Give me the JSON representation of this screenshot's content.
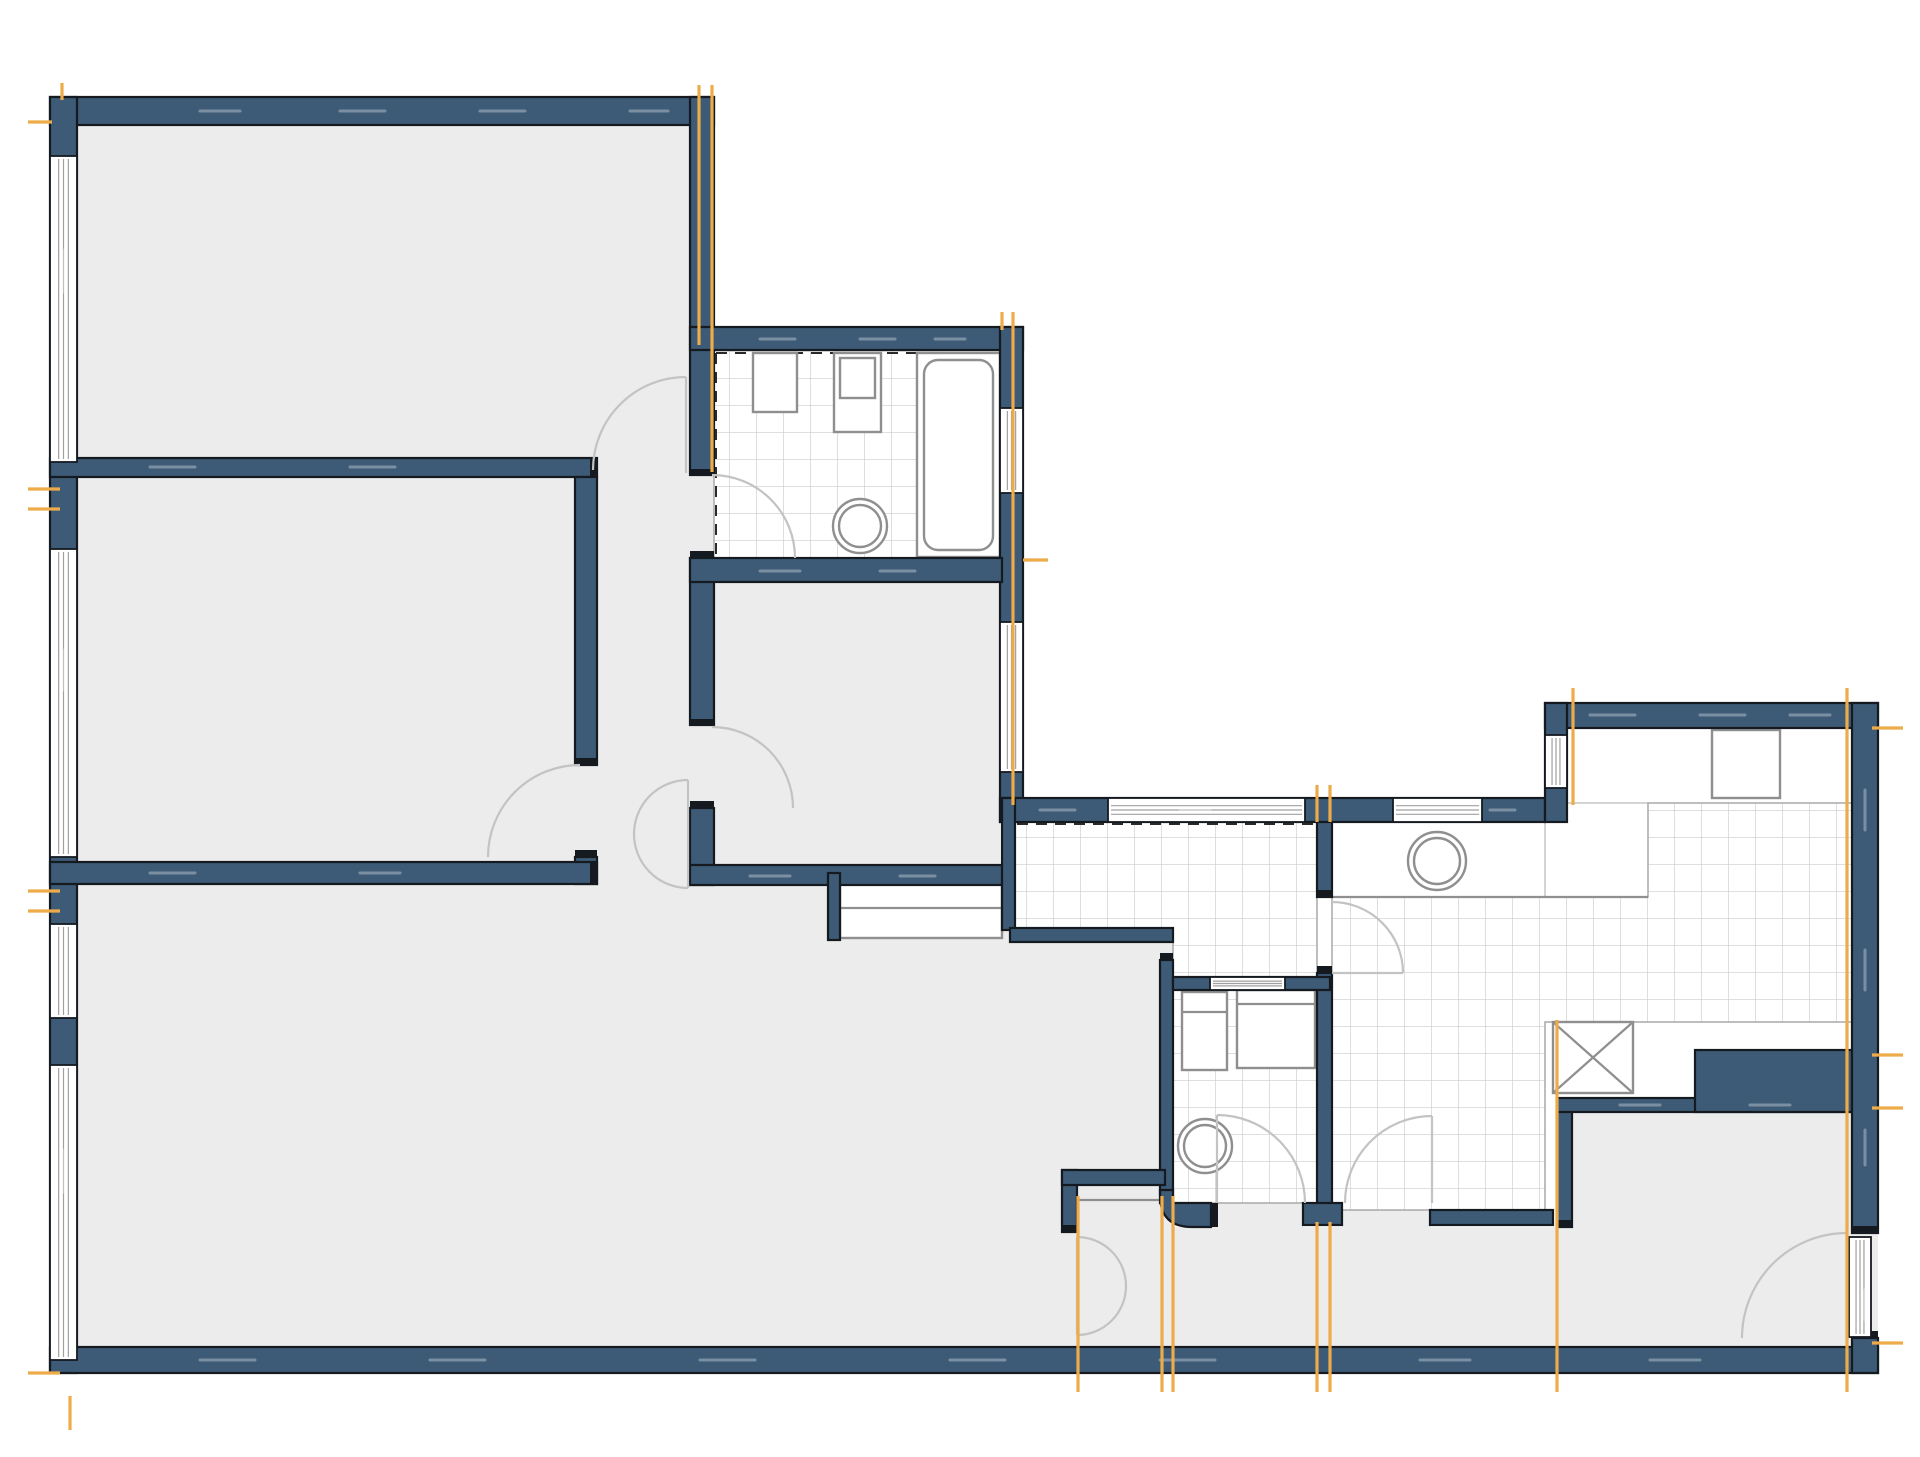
{
  "canvas": {
    "width": 1920,
    "height": 1457,
    "background": "#ffffff"
  },
  "palette": {
    "wall_fill": "#3d5a76",
    "wall_outline": "#151a20",
    "floor_gray": "#ececec",
    "floor_white": "#ffffff",
    "tile_line": "#cccccc",
    "tile_edge": "#a8a8a8",
    "fixture_line": "#8f8f8f",
    "door_arc": "#c3c3c3",
    "window_line": "#a0a0a0",
    "marker_orange": "#edab49",
    "wall_dash": "rgba(255,255,255,0.32)",
    "tile_dash": "#2a2a2a"
  },
  "floors": {
    "gray": [
      {
        "name": "room-top-left-floor",
        "rect": [
          77,
          125,
          613,
          333
        ]
      },
      {
        "name": "room-mid-left-floor",
        "rect": [
          77,
          477,
          498,
          385
        ]
      },
      {
        "name": "hallway-floor",
        "rect": [
          597,
          458,
          93,
          430
        ]
      },
      {
        "name": "room-center-floor",
        "rect": [
          714,
          582,
          286,
          283
        ]
      },
      {
        "name": "room-bottom-left-floor",
        "rect": [
          77,
          884,
          985,
          463
        ]
      },
      {
        "name": "floor-notch",
        "rect": [
          1010,
          942,
          163,
          405
        ]
      },
      {
        "name": "corridor-floor",
        "rect": [
          1077,
          1227,
          495,
          120
        ]
      },
      {
        "name": "entry-room-floor",
        "rect": [
          1572,
          1112,
          280,
          235
        ]
      },
      {
        "name": "doorway-bathroom",
        "rect": [
          690,
          475,
          24,
          83
        ]
      },
      {
        "name": "doorway-center-room",
        "rect": [
          690,
          725,
          24,
          83
        ]
      },
      {
        "name": "doorway-room-mid-left",
        "rect": [
          575,
          765,
          22,
          92
        ]
      },
      {
        "name": "doorway-wc",
        "rect": [
          1211,
          1203,
          92,
          24
        ]
      },
      {
        "name": "doorway-shower-room",
        "rect": [
          1342,
          1203,
          88,
          24
        ]
      },
      {
        "name": "doorway-entry-threshold",
        "rect": [
          1852,
          1233,
          26,
          105
        ]
      }
    ],
    "white": [
      {
        "name": "kitchen-upper-band",
        "rect": [
          1567,
          728,
          285,
          75
        ]
      },
      {
        "name": "counter-band",
        "rect": [
          1332,
          822,
          213,
          75
        ]
      },
      {
        "name": "niche-slot",
        "rect": [
          1710,
          1062,
          135,
          33
        ]
      }
    ]
  },
  "tile_areas": [
    {
      "name": "bathroom-tiles",
      "points": "714,350 1000,350 1000,558 714,558"
    },
    {
      "name": "laundry-tiles",
      "points": "1015,822 1317,822 1317,977 1173,977 1173,942 1015,942"
    },
    {
      "name": "wc-tiles",
      "points": "1173,990 1317,990 1317,1203 1173,1203"
    },
    {
      "name": "kitchen-tiles",
      "points": "1332,897 1648,897 1648,803 1852,803 1852,1022 1545,1022 1545,1210 1332,1210"
    }
  ],
  "tile_dashes": [
    "M 716 353 L 998 353",
    "M 716 353 L 716 556",
    "M 1017 824 L 1315 824"
  ],
  "walls": [
    {
      "name": "wall-top",
      "rect": [
        50,
        97,
        664,
        28
      ]
    },
    {
      "name": "wall-left",
      "rect": [
        50,
        97,
        27,
        1276
      ]
    },
    {
      "name": "wall-bottom",
      "rect": [
        50,
        1347,
        1828,
        26
      ]
    },
    {
      "name": "wall-room1-right",
      "rect": [
        690,
        97,
        24,
        378
      ]
    },
    {
      "name": "wall-west-mid-a",
      "rect": [
        690,
        558,
        24,
        167
      ]
    },
    {
      "name": "wall-west-mid-b",
      "rect": [
        690,
        808,
        24,
        77
      ]
    },
    {
      "name": "wall-bathroom-top",
      "rect": [
        690,
        327,
        333,
        23
      ]
    },
    {
      "name": "wall-bathroom-east",
      "rect": [
        1000,
        327,
        23,
        495
      ]
    },
    {
      "name": "wall-bathroom-bottom",
      "rect": [
        690,
        558,
        312,
        24
      ]
    },
    {
      "name": "wall-laundry-top",
      "rect": [
        1000,
        798,
        545,
        24
      ]
    },
    {
      "name": "wall-divider-rooms-1-2",
      "rect": [
        50,
        458,
        547,
        19
      ]
    },
    {
      "name": "wall-room2-east",
      "rect": [
        575,
        477,
        22,
        288
      ]
    },
    {
      "name": "wall-room2-east-stub",
      "rect": [
        575,
        857,
        22,
        27
      ]
    },
    {
      "name": "wall-divider-room2-bottom",
      "rect": [
        50,
        862,
        547,
        22
      ]
    },
    {
      "name": "wall-center-room-bottom",
      "rect": [
        690,
        865,
        317,
        20
      ]
    },
    {
      "name": "wall-closet-stub",
      "rect": [
        828,
        873,
        12,
        67
      ]
    },
    {
      "name": "wall-laundry-west",
      "rect": [
        1002,
        798,
        13,
        132
      ]
    },
    {
      "name": "wall-laundry-west-turn",
      "rect": [
        1010,
        928,
        163,
        14
      ]
    },
    {
      "name": "wall-wc-west",
      "rect": [
        1160,
        960,
        13,
        243
      ]
    },
    {
      "name": "wall-wc-divider-east",
      "rect": [
        1317,
        973,
        15,
        240
      ]
    },
    {
      "name": "wall-wc-top",
      "rect": [
        1173,
        977,
        157,
        13
      ]
    },
    {
      "name": "wall-wc-bottom-stub",
      "rect": [
        1303,
        1203,
        39,
        22
      ]
    },
    {
      "name": "wall-divider-upper",
      "rect": [
        1317,
        822,
        15,
        75
      ]
    },
    {
      "name": "wall-sill",
      "rect": [
        1430,
        1210,
        123,
        15
      ]
    },
    {
      "name": "wall-entry-west",
      "rect": [
        1557,
        1102,
        15,
        125
      ]
    },
    {
      "name": "wall-entry-top",
      "rect": [
        1557,
        1098,
        295,
        14
      ]
    },
    {
      "name": "wall-niche-block",
      "rect": [
        1695,
        1050,
        157,
        62
      ]
    },
    {
      "name": "wall-kitchen-top",
      "rect": [
        1545,
        703,
        333,
        25
      ]
    },
    {
      "name": "wall-kitchen-left",
      "rect": [
        1545,
        703,
        22,
        119
      ]
    },
    {
      "name": "wall-right-upper",
      "rect": [
        1852,
        703,
        26,
        530
      ]
    },
    {
      "name": "wall-right-lower",
      "rect": [
        1852,
        1338,
        26,
        35
      ]
    },
    {
      "name": "wall-bottomroom-east-stub",
      "rect": [
        1062,
        1170,
        15,
        62
      ]
    },
    {
      "name": "wall-jut",
      "rect": [
        1062,
        1170,
        103,
        15
      ]
    }
  ],
  "wall_paths": [
    {
      "name": "wall-wc-rounded-corner",
      "d": "M 1173 1190 L 1173 1203 L 1211 1203 L 1211 1227 L 1192 1227 Q 1160 1227 1160 1195 L 1160 1190 Z"
    }
  ],
  "wall_caps": [
    [
      690,
      469,
      24,
      7
    ],
    [
      690,
      551,
      24,
      7
    ],
    [
      690,
      719,
      24,
      7
    ],
    [
      690,
      801,
      24,
      7
    ],
    [
      590,
      458,
      7,
      19
    ],
    [
      590,
      862,
      7,
      22
    ],
    [
      575,
      758,
      22,
      7
    ],
    [
      575,
      850,
      22,
      7
    ],
    [
      1062,
      1225,
      15,
      7
    ],
    [
      1317,
      890,
      15,
      7
    ],
    [
      1317,
      966,
      15,
      7
    ],
    [
      1211,
      1203,
      7,
      24
    ],
    [
      1557,
      1220,
      15,
      7
    ],
    [
      1852,
      1226,
      26,
      7
    ],
    [
      1852,
      1331,
      26,
      7
    ],
    [
      1160,
      953,
      13,
      7
    ]
  ],
  "windows": [
    {
      "name": "window-left-1",
      "rect": [
        50,
        156,
        27,
        306
      ],
      "orient": "v"
    },
    {
      "name": "window-left-2",
      "rect": [
        50,
        549,
        27,
        308
      ],
      "orient": "v"
    },
    {
      "name": "window-left-3",
      "rect": [
        50,
        924,
        27,
        94
      ],
      "orient": "v"
    },
    {
      "name": "window-left-4",
      "rect": [
        50,
        1065,
        27,
        295
      ],
      "orient": "v"
    },
    {
      "name": "window-east-1",
      "rect": [
        1000,
        408,
        23,
        85
      ],
      "orient": "v"
    },
    {
      "name": "window-east-2",
      "rect": [
        1000,
        622,
        23,
        150
      ],
      "orient": "v"
    },
    {
      "name": "window-laundry-1",
      "rect": [
        1108,
        798,
        197,
        24
      ],
      "orient": "h"
    },
    {
      "name": "window-laundry-2",
      "rect": [
        1393,
        798,
        89,
        24
      ],
      "orient": "h"
    },
    {
      "name": "window-kitchen-left",
      "rect": [
        1545,
        735,
        22,
        53
      ],
      "orient": "v"
    },
    {
      "name": "window-wc-slot",
      "rect": [
        1210,
        977,
        75,
        13
      ],
      "orient": "h"
    },
    {
      "name": "entry-door-leaf",
      "rect": [
        1849,
        1237,
        22,
        100
      ],
      "orient": "v"
    }
  ],
  "doors": [
    {
      "name": "door-room-top-left",
      "paths": [
        "M 686 377 L 686 473",
        "M 686 377 A 93 93 0 0 0 593 470"
      ]
    },
    {
      "name": "door-bathroom",
      "paths": [
        "M 712 475 A 83 83 0 0 1 795 558"
      ]
    },
    {
      "name": "door-center-room",
      "paths": [
        "M 712 727 A 81 81 0 0 1 793 808"
      ]
    },
    {
      "name": "door-room-mid-left",
      "paths": [
        "M 580 765 A 92 92 0 0 0 488 857"
      ]
    },
    {
      "name": "door-hallway-double",
      "paths": [
        "M 688 780 L 688 888",
        "M 688 780 A 54 54 0 0 0 634 834",
        "M 688 888 A 54 54 0 0 1 634 834"
      ]
    },
    {
      "name": "door-corridor-double",
      "paths": [
        "M 1077 1237 L 1077 1335",
        "M 1077 1237 A 49 49 0 0 1 1126 1286",
        "M 1077 1335 A 49 49 0 0 0 1126 1286"
      ]
    },
    {
      "name": "door-wc",
      "paths": [
        "M 1217 1115 L 1217 1203",
        "M 1217 1115 A 88 88 0 0 1 1305 1203"
      ]
    },
    {
      "name": "door-shower-room",
      "paths": [
        "M 1432 1116 L 1432 1203",
        "M 1432 1116 A 87 87 0 0 0 1345 1203"
      ]
    },
    {
      "name": "door-laundry-shower",
      "paths": [
        "M 1332 973 L 1403 973",
        "M 1332 902 A 71 71 0 0 1 1403 973"
      ]
    },
    {
      "name": "door-entry-swing",
      "paths": [
        "M 1742 1338 A 105 105 0 0 1 1847 1233"
      ]
    }
  ],
  "fixtures": [
    {
      "name": "closet-shelf",
      "shapes": [
        {
          "type": "rect",
          "rect": [
            840,
            878,
            162,
            60
          ]
        },
        {
          "type": "line",
          "line": [
            840,
            908,
            1002,
            908
          ]
        }
      ]
    },
    {
      "name": "bathroom-sink-1",
      "shapes": [
        {
          "type": "rect",
          "rect": [
            753,
            353,
            44,
            59
          ]
        }
      ]
    },
    {
      "name": "bathroom-sink-2",
      "shapes": [
        {
          "type": "rect",
          "rect": [
            834,
            353,
            47,
            79
          ]
        },
        {
          "type": "rect",
          "rect": [
            840,
            358,
            35,
            40
          ]
        }
      ]
    },
    {
      "name": "bathtub",
      "shapes": [
        {
          "type": "rect",
          "rect": [
            917,
            353,
            83,
            204
          ]
        },
        {
          "type": "rect",
          "rect": [
            924,
            360,
            69,
            190
          ],
          "rx": 14
        }
      ]
    },
    {
      "name": "bathroom-toilet",
      "shapes": [
        {
          "type": "circle",
          "c": [
            860,
            526,
            27
          ]
        },
        {
          "type": "circle",
          "c": [
            860,
            526,
            21
          ]
        }
      ]
    },
    {
      "name": "wc-washing-machine",
      "shapes": [
        {
          "type": "rect",
          "rect": [
            1237,
            990,
            78,
            78
          ]
        },
        {
          "type": "line",
          "line": [
            1237,
            1004,
            1315,
            1004
          ]
        }
      ]
    },
    {
      "name": "wc-cabinet",
      "shapes": [
        {
          "type": "rect",
          "rect": [
            1182,
            992,
            45,
            78
          ]
        },
        {
          "type": "line",
          "line": [
            1182,
            1012,
            1227,
            1012
          ]
        }
      ]
    },
    {
      "name": "wc-toilet",
      "shapes": [
        {
          "type": "circle",
          "c": [
            1205,
            1146,
            27
          ]
        },
        {
          "type": "circle",
          "c": [
            1205,
            1146,
            21
          ]
        }
      ]
    },
    {
      "name": "shower-room-sink",
      "shapes": [
        {
          "type": "circle",
          "c": [
            1437,
            861,
            29
          ]
        },
        {
          "type": "circle",
          "c": [
            1437,
            861,
            23
          ]
        }
      ]
    },
    {
      "name": "counter-edge",
      "shapes": [
        {
          "type": "line",
          "line": [
            1332,
            897,
            1648,
            897
          ]
        }
      ]
    },
    {
      "name": "kitchen-stove",
      "shapes": [
        {
          "type": "rect",
          "rect": [
            1712,
            730,
            68,
            68
          ]
        }
      ]
    },
    {
      "name": "shaft-crossed-box",
      "shapes": [
        {
          "type": "rect",
          "rect": [
            1553,
            1022,
            80,
            71
          ]
        },
        {
          "type": "line",
          "line": [
            1553,
            1022,
            1633,
            1093
          ]
        },
        {
          "type": "line",
          "line": [
            1633,
            1022,
            1553,
            1093
          ]
        }
      ]
    },
    {
      "name": "jut-counter-line",
      "shapes": [
        {
          "type": "line",
          "line": [
            1077,
            1200,
            1160,
            1200
          ]
        }
      ]
    }
  ],
  "markers": [
    [
      62,
      83,
      62,
      100
    ],
    [
      28,
      122,
      52,
      122
    ],
    [
      699,
      85,
      699,
      345
    ],
    [
      712,
      85,
      712,
      472
    ],
    [
      1002,
      312,
      1002,
      330
    ],
    [
      1013,
      312,
      1013,
      805
    ],
    [
      1023,
      560,
      1048,
      560
    ],
    [
      1317,
      785,
      1317,
      822
    ],
    [
      1330,
      785,
      1330,
      822
    ],
    [
      1573,
      688,
      1573,
      805
    ],
    [
      1847,
      688,
      1847,
      1392
    ],
    [
      28,
      489,
      60,
      489
    ],
    [
      28,
      509,
      60,
      509
    ],
    [
      28,
      891,
      60,
      891
    ],
    [
      28,
      911,
      60,
      911
    ],
    [
      28,
      1373,
      60,
      1373
    ],
    [
      70,
      1396,
      70,
      1430
    ],
    [
      1078,
      1196,
      1078,
      1392
    ],
    [
      1162,
      1196,
      1162,
      1392
    ],
    [
      1173,
      1196,
      1173,
      1392
    ],
    [
      1317,
      1222,
      1317,
      1392
    ],
    [
      1330,
      1222,
      1330,
      1392
    ],
    [
      1557,
      1020,
      1557,
      1392
    ],
    [
      1872,
      728,
      1903,
      728
    ],
    [
      1872,
      1055,
      1903,
      1055
    ],
    [
      1872,
      1108,
      1903,
      1108
    ],
    [
      1872,
      1343,
      1903,
      1343
    ]
  ],
  "wall_dashes": [
    [
      200,
      111,
      240,
      111
    ],
    [
      340,
      111,
      385,
      111
    ],
    [
      480,
      111,
      525,
      111
    ],
    [
      630,
      111,
      668,
      111
    ],
    [
      760,
      339,
      795,
      339
    ],
    [
      860,
      339,
      895,
      339
    ],
    [
      935,
      339,
      965,
      339
    ],
    [
      1040,
      810,
      1075,
      810
    ],
    [
      1180,
      810,
      1210,
      810
    ],
    [
      1490,
      810,
      1515,
      810
    ],
    [
      1590,
      715,
      1635,
      715
    ],
    [
      1700,
      715,
      1745,
      715
    ],
    [
      1790,
      715,
      1830,
      715
    ],
    [
      63,
      250,
      63,
      292
    ],
    [
      63,
      650,
      63,
      690
    ],
    [
      63,
      1150,
      63,
      1192
    ],
    [
      1865,
      790,
      1865,
      830
    ],
    [
      1865,
      950,
      1865,
      990
    ],
    [
      1865,
      1130,
      1865,
      1165
    ],
    [
      1865,
      1290,
      1865,
      1320
    ],
    [
      200,
      1360,
      255,
      1360
    ],
    [
      430,
      1360,
      485,
      1360
    ],
    [
      700,
      1360,
      755,
      1360
    ],
    [
      950,
      1360,
      1005,
      1360
    ],
    [
      1160,
      1360,
      1215,
      1360
    ],
    [
      1420,
      1360,
      1470,
      1360
    ],
    [
      1650,
      1360,
      1700,
      1360
    ],
    [
      1620,
      1105,
      1660,
      1105
    ],
    [
      1750,
      1105,
      1790,
      1105
    ],
    [
      150,
      467,
      195,
      467
    ],
    [
      350,
      467,
      395,
      467
    ],
    [
      150,
      873,
      195,
      873
    ],
    [
      360,
      873,
      400,
      873
    ],
    [
      760,
      571,
      800,
      571
    ],
    [
      880,
      571,
      915,
      571
    ],
    [
      750,
      876,
      790,
      876
    ],
    [
      900,
      876,
      935,
      876
    ]
  ]
}
